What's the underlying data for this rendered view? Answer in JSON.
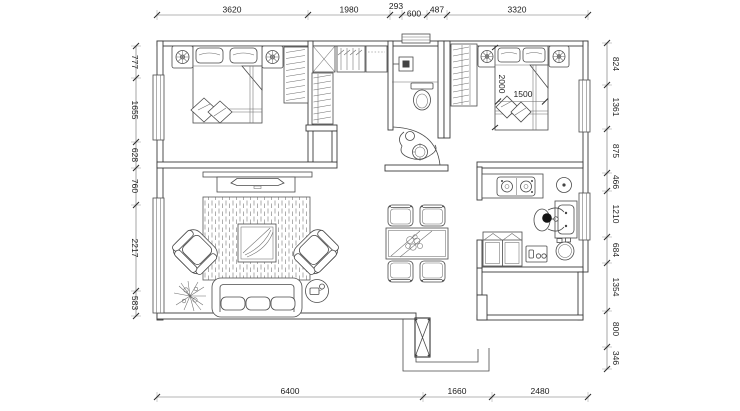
{
  "drawing": {
    "type": "apartment-floor-plan",
    "background_color": "#ffffff",
    "line_color": "#3a3a3a",
    "text_color": "#1c1c1c"
  },
  "dimensions": {
    "top": [
      "3620",
      "1980",
      "293",
      "600",
      "487",
      "3320"
    ],
    "left": [
      "777",
      "1655",
      "628",
      "760",
      "2217",
      "583"
    ],
    "right": [
      "824",
      "1361",
      "875",
      "466",
      "1210",
      "684",
      "1354",
      "800",
      "346"
    ],
    "bottom": [
      "6400",
      "1660",
      "2480"
    ],
    "bed": {
      "length": "2000",
      "width": "1500"
    }
  }
}
